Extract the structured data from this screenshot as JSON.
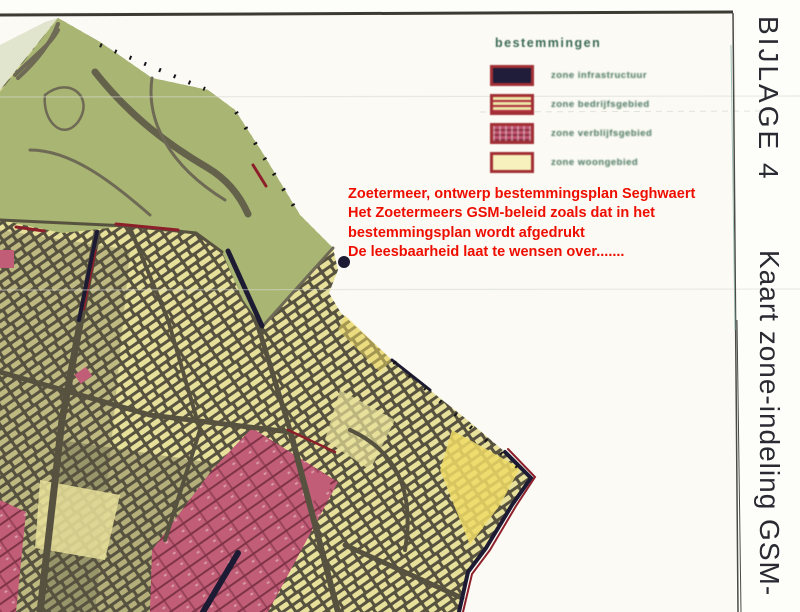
{
  "page": {
    "paper_color": "#fbfaf5"
  },
  "margin_labels": {
    "bijlage": "BIJLAGE 4",
    "kaart": "Kaart zone-indeling GSM-",
    "text_color": "#2a2a32"
  },
  "annotation": {
    "color": "#ee0e00",
    "lines": [
      "Zoetermeer, ontwerp bestemmingsplan Seghwaert",
      "Het Zoetermeers GSM-beleid zoals dat in het",
      "bestemmingsplan wordt afgedrukt",
      "De leesbaarheid laat te wensen over......."
    ]
  },
  "legend": {
    "title": "bestemmingen",
    "title_color": "#3b6a52",
    "label_color": "#4a775d",
    "swatch_border_color": "#a22f34",
    "items": [
      {
        "label": "zone infrastructuur",
        "fill": "#201d3a",
        "pattern": "solid"
      },
      {
        "label": "zone bedrijfsgebied",
        "fill": "#ece6a6",
        "pattern": "red-hatch"
      },
      {
        "label": "zone verblijfsgebied",
        "fill": "#bf5470",
        "pattern": "dense-hatch"
      },
      {
        "label": "zone woongebied",
        "fill": "#f6f1bd",
        "pattern": "solid"
      }
    ]
  },
  "map": {
    "colors": {
      "park_green": "#a9b572",
      "urban_yellow": "#e7e09a",
      "urban_dark": "#57523f",
      "pink_zone": "#c25d78",
      "pink_dark": "#7e3347",
      "navy": "#1c1b33",
      "dark_red": "#8c1f2a",
      "bright_yellow": "#eeda66",
      "road_gray": "#6e6a55",
      "park_path_dark": "#5d5948",
      "scan_line": "#3b3b33",
      "streak": "#d8d8d2",
      "page_edge": "#4a4a46",
      "page_edge_teal": "#8fb6ac"
    }
  }
}
